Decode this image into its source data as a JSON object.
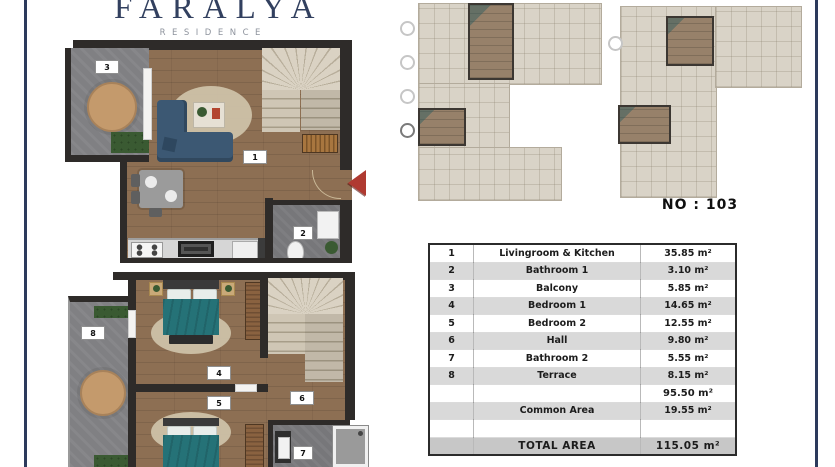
{
  "logo": {
    "title": "FARALYA",
    "subtitle": "RESIDENCE"
  },
  "unit": {
    "label": "NO : 103"
  },
  "plan_markers": {
    "living": "1",
    "bath1": "2",
    "balcony": "3",
    "bed1": "4",
    "bed2": "5",
    "hall": "6",
    "bath2": "7",
    "terrace": "8"
  },
  "area_table": {
    "rows": [
      {
        "num": "1",
        "name": "Livingroom & Kitchen",
        "area": "35.85 m²"
      },
      {
        "num": "2",
        "name": "Bathroom 1",
        "area": "3.10 m²"
      },
      {
        "num": "3",
        "name": "Balcony",
        "area": "5.85 m²"
      },
      {
        "num": "4",
        "name": "Bedroom 1",
        "area": "14.65 m²"
      },
      {
        "num": "5",
        "name": "Bedroom 2",
        "area": "12.55 m²"
      },
      {
        "num": "6",
        "name": "Hall",
        "area": "9.80 m²"
      },
      {
        "num": "7",
        "name": "Bathroom 2",
        "area": "5.55 m²"
      },
      {
        "num": "8",
        "name": "Terrace",
        "area": "8.15 m²"
      }
    ],
    "subtotal_area": "95.50 m²",
    "common_row": {
      "name": "Common Area",
      "area": "19.55 m²"
    },
    "total_row": {
      "label": "TOTAL AREA",
      "area": "115.05 m²"
    }
  },
  "colors": {
    "navy": "#2c3a5c",
    "wall": "#2e2b29",
    "wood": "#8d6f53",
    "tile": "#808083",
    "sofa": "#3c5873",
    "teal": "#257277",
    "stair": "#cfc6b5",
    "rug": "#cdc1a8",
    "rowgray": "#d9d9d9",
    "totalgray": "#c7c7c7",
    "red": "#b03a31",
    "keyplan": "#d9d3c7"
  }
}
